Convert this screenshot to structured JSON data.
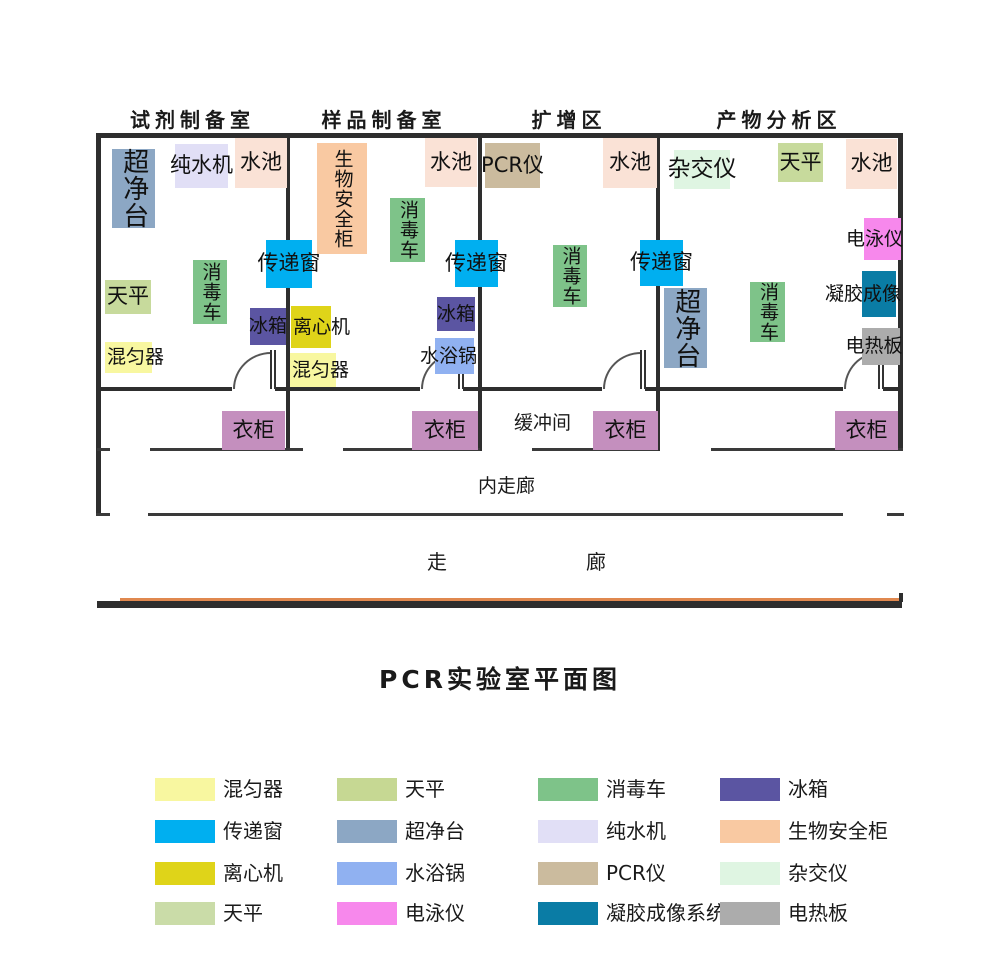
{
  "title": "PCR实验室平面图",
  "rooms": [
    {
      "name": "试剂制备室"
    },
    {
      "name": "样品制备室"
    },
    {
      "name": "扩增区"
    },
    {
      "name": "产物分析区"
    }
  ],
  "labels": {
    "buffer_room": "缓冲间",
    "inner_corridor": "内走廊",
    "corridor_left": "走",
    "corridor_right": "廊",
    "wardrobe": "衣柜"
  },
  "equipment": {
    "clean_bench": "超净台",
    "water_purifier": "纯水机",
    "sink": "水池",
    "disinfect_cart": "消毒车",
    "transfer_window": "传递窗",
    "balance": "天平",
    "fridge": "冰箱",
    "mixer": "混匀器",
    "biosafety_cabinet": "生物安全柜",
    "centrifuge": "离心机",
    "water_bath": "水浴锅",
    "pcr_machine": "PCR仪",
    "hybridizer": "杂交仪",
    "electrophoresis": "电泳仪",
    "gel_imaging": "凝胶成像",
    "hot_plate": "电热板"
  },
  "colors": {
    "clean_bench": "#8CA7C4",
    "water_purifier": "#E1DFF6",
    "sink": "#FAE2D6",
    "disinfect_cart": "#7EC389",
    "transfer_window": "#00AFF0",
    "balance": "#C7DA9C",
    "fridge": "#5B55A2",
    "mixer": "#F8F7A0",
    "biosafety_cabinet": "#F9C9A2",
    "centrifuge": "#DFD419",
    "water_bath": "#90B1F1",
    "pcr_machine": "#CBBB9E",
    "hybridizer": "#DFF5E2",
    "electrophoresis": "#F788EC",
    "gel_imaging": "#0A7CA5",
    "hot_plate": "#ACACAC",
    "wardrobe": "#C48FBE",
    "wall": "#2e2e2e",
    "floor_accent_line": "#E0884F"
  },
  "legend": {
    "items": [
      {
        "label": "混匀器",
        "color": "#F8F7A0"
      },
      {
        "label": "天平",
        "color": "#C6D893"
      },
      {
        "label": "消毒车",
        "color": "#7EC389"
      },
      {
        "label": "冰箱",
        "color": "#5B55A2"
      },
      {
        "label": "传递窗",
        "color": "#00AFF0"
      },
      {
        "label": "超净台",
        "color": "#8CA7C4"
      },
      {
        "label": "纯水机",
        "color": "#E1DFF6"
      },
      {
        "label": "生物安全柜",
        "color": "#F9C9A2"
      },
      {
        "label": "离心机",
        "color": "#DFD419"
      },
      {
        "label": "水浴锅",
        "color": "#90B1F1"
      },
      {
        "label": "PCR仪",
        "color": "#CBBB9E"
      },
      {
        "label": "杂交仪",
        "color": "#DFF5E2"
      },
      {
        "label": "天平",
        "color": "#CADCA8"
      },
      {
        "label": "电泳仪",
        "color": "#F788EC"
      },
      {
        "label": "凝胶成像系统",
        "color": "#0A7CA5"
      },
      {
        "label": "电热板",
        "color": "#ACACAC"
      }
    ]
  }
}
